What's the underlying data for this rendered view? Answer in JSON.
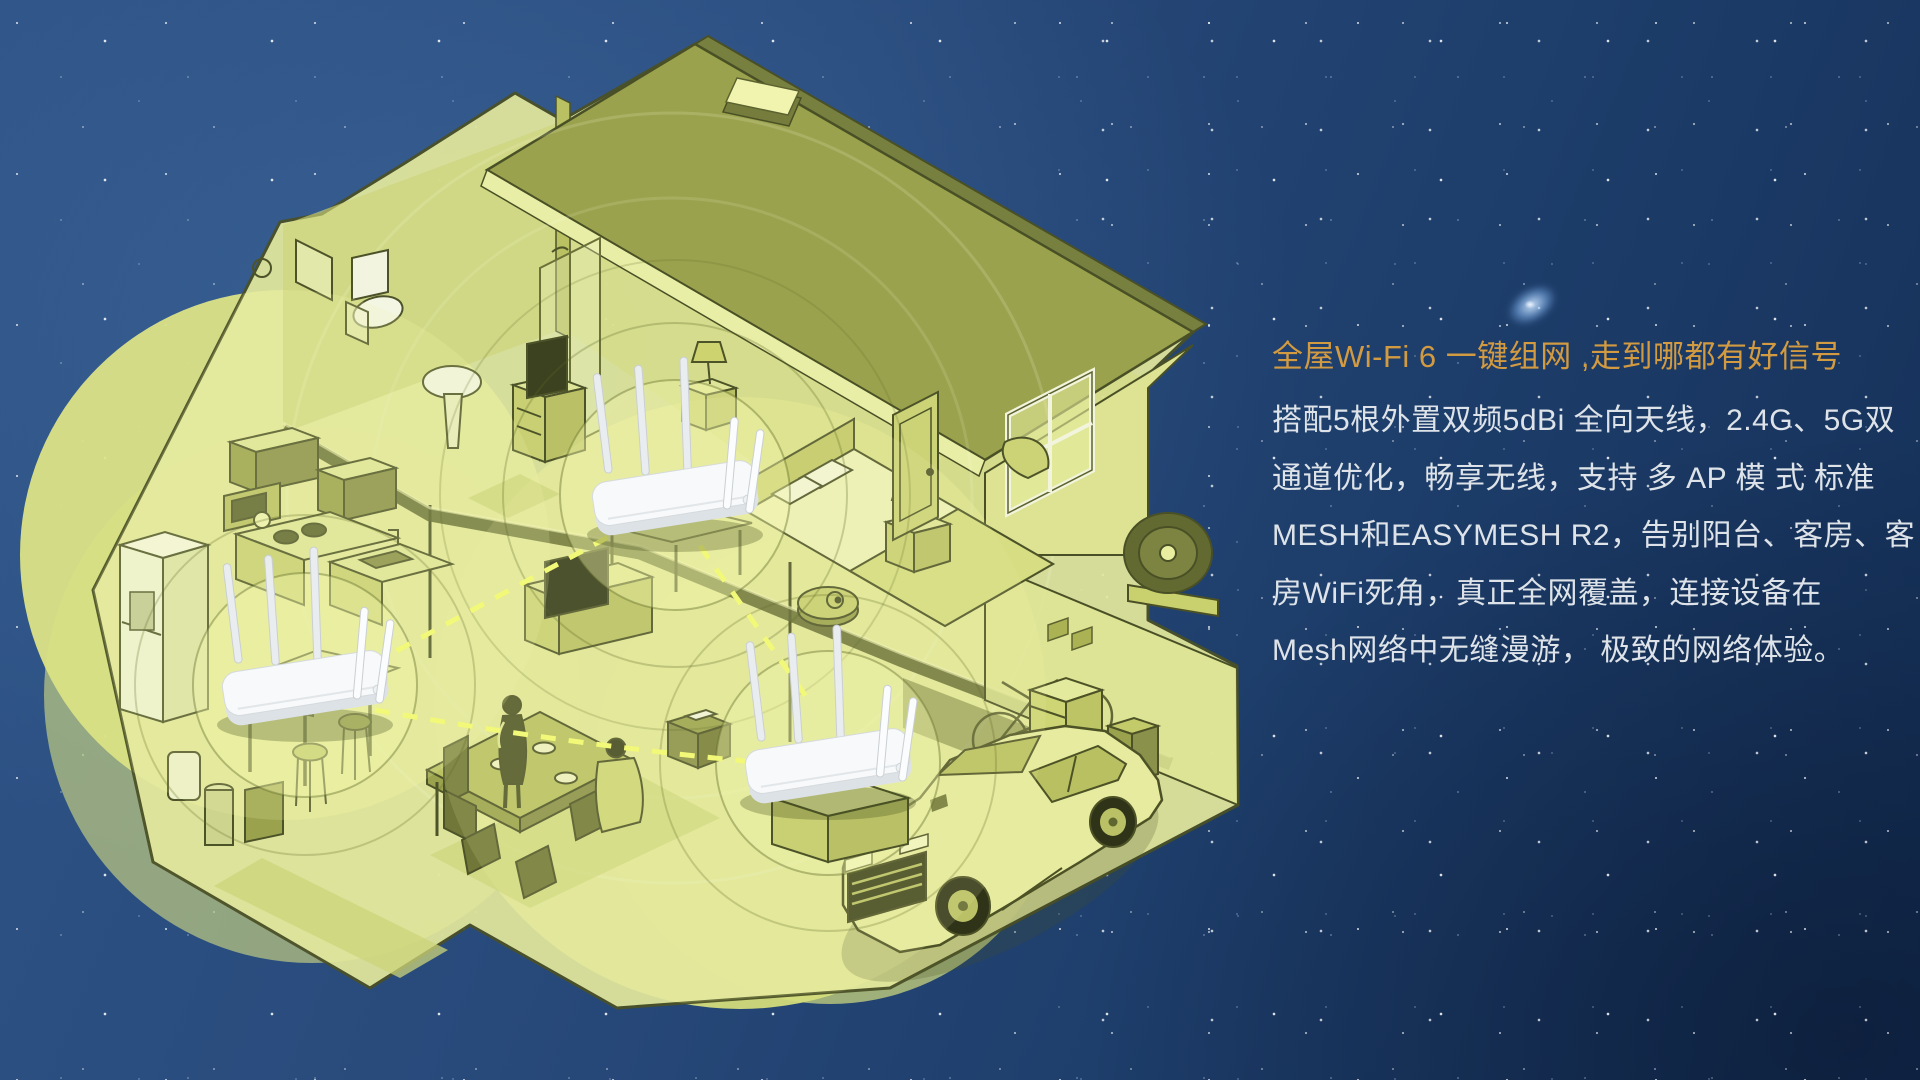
{
  "page": {
    "type": "product-hero-banner",
    "theme": "Whole-home Wi-Fi 6 one-key mesh networking"
  },
  "text_panel": {
    "title": "全屋Wi-Fi 6 一键组网 ,走到哪都有好信号",
    "lines": [
      "搭配5根外置双频5dBi 全向天线，2.4G、5G双",
      "通道优化，畅享无线，支持 多 AP 模 式 标准",
      "MESH和EASYMESH R2，告别阳台、客房、客",
      "房WiFi死角，真正全网覆盖，连接设备在",
      "Mesh网络中无缝漫游， 极致的网络体验。"
    ]
  },
  "palette": {
    "sky_blue": "#27497a",
    "sky_deep": "#142f56",
    "title_orange": "#d29a41",
    "body_text": "#dde3e8",
    "coverage_yellow_green": "#dce387",
    "house_fill": "#e3e89c",
    "house_outline": "#4a5026",
    "roof_olive": "#9aa14c",
    "router_white": "#f7f9fa",
    "mesh_dash_yellow": "#f2f878",
    "star_white": "#cfe4ff"
  },
  "illustration": {
    "description": "Isometric cutaway two-story home at night: three white five-antenna mesh routers (upstairs bedroom, kitchen bar, garage) with circular Wi-Fi coverage zones and dashed mesh links; rooms show bathroom, bedroom, kitchen, dining family, garage with car, bicycle and robot vacuum",
    "routers": [
      {
        "id": "bedroom-router",
        "location": "upstairs bedroom"
      },
      {
        "id": "kitchen-router",
        "location": "kitchen bar counter"
      },
      {
        "id": "garage-router",
        "location": "garage"
      }
    ]
  }
}
